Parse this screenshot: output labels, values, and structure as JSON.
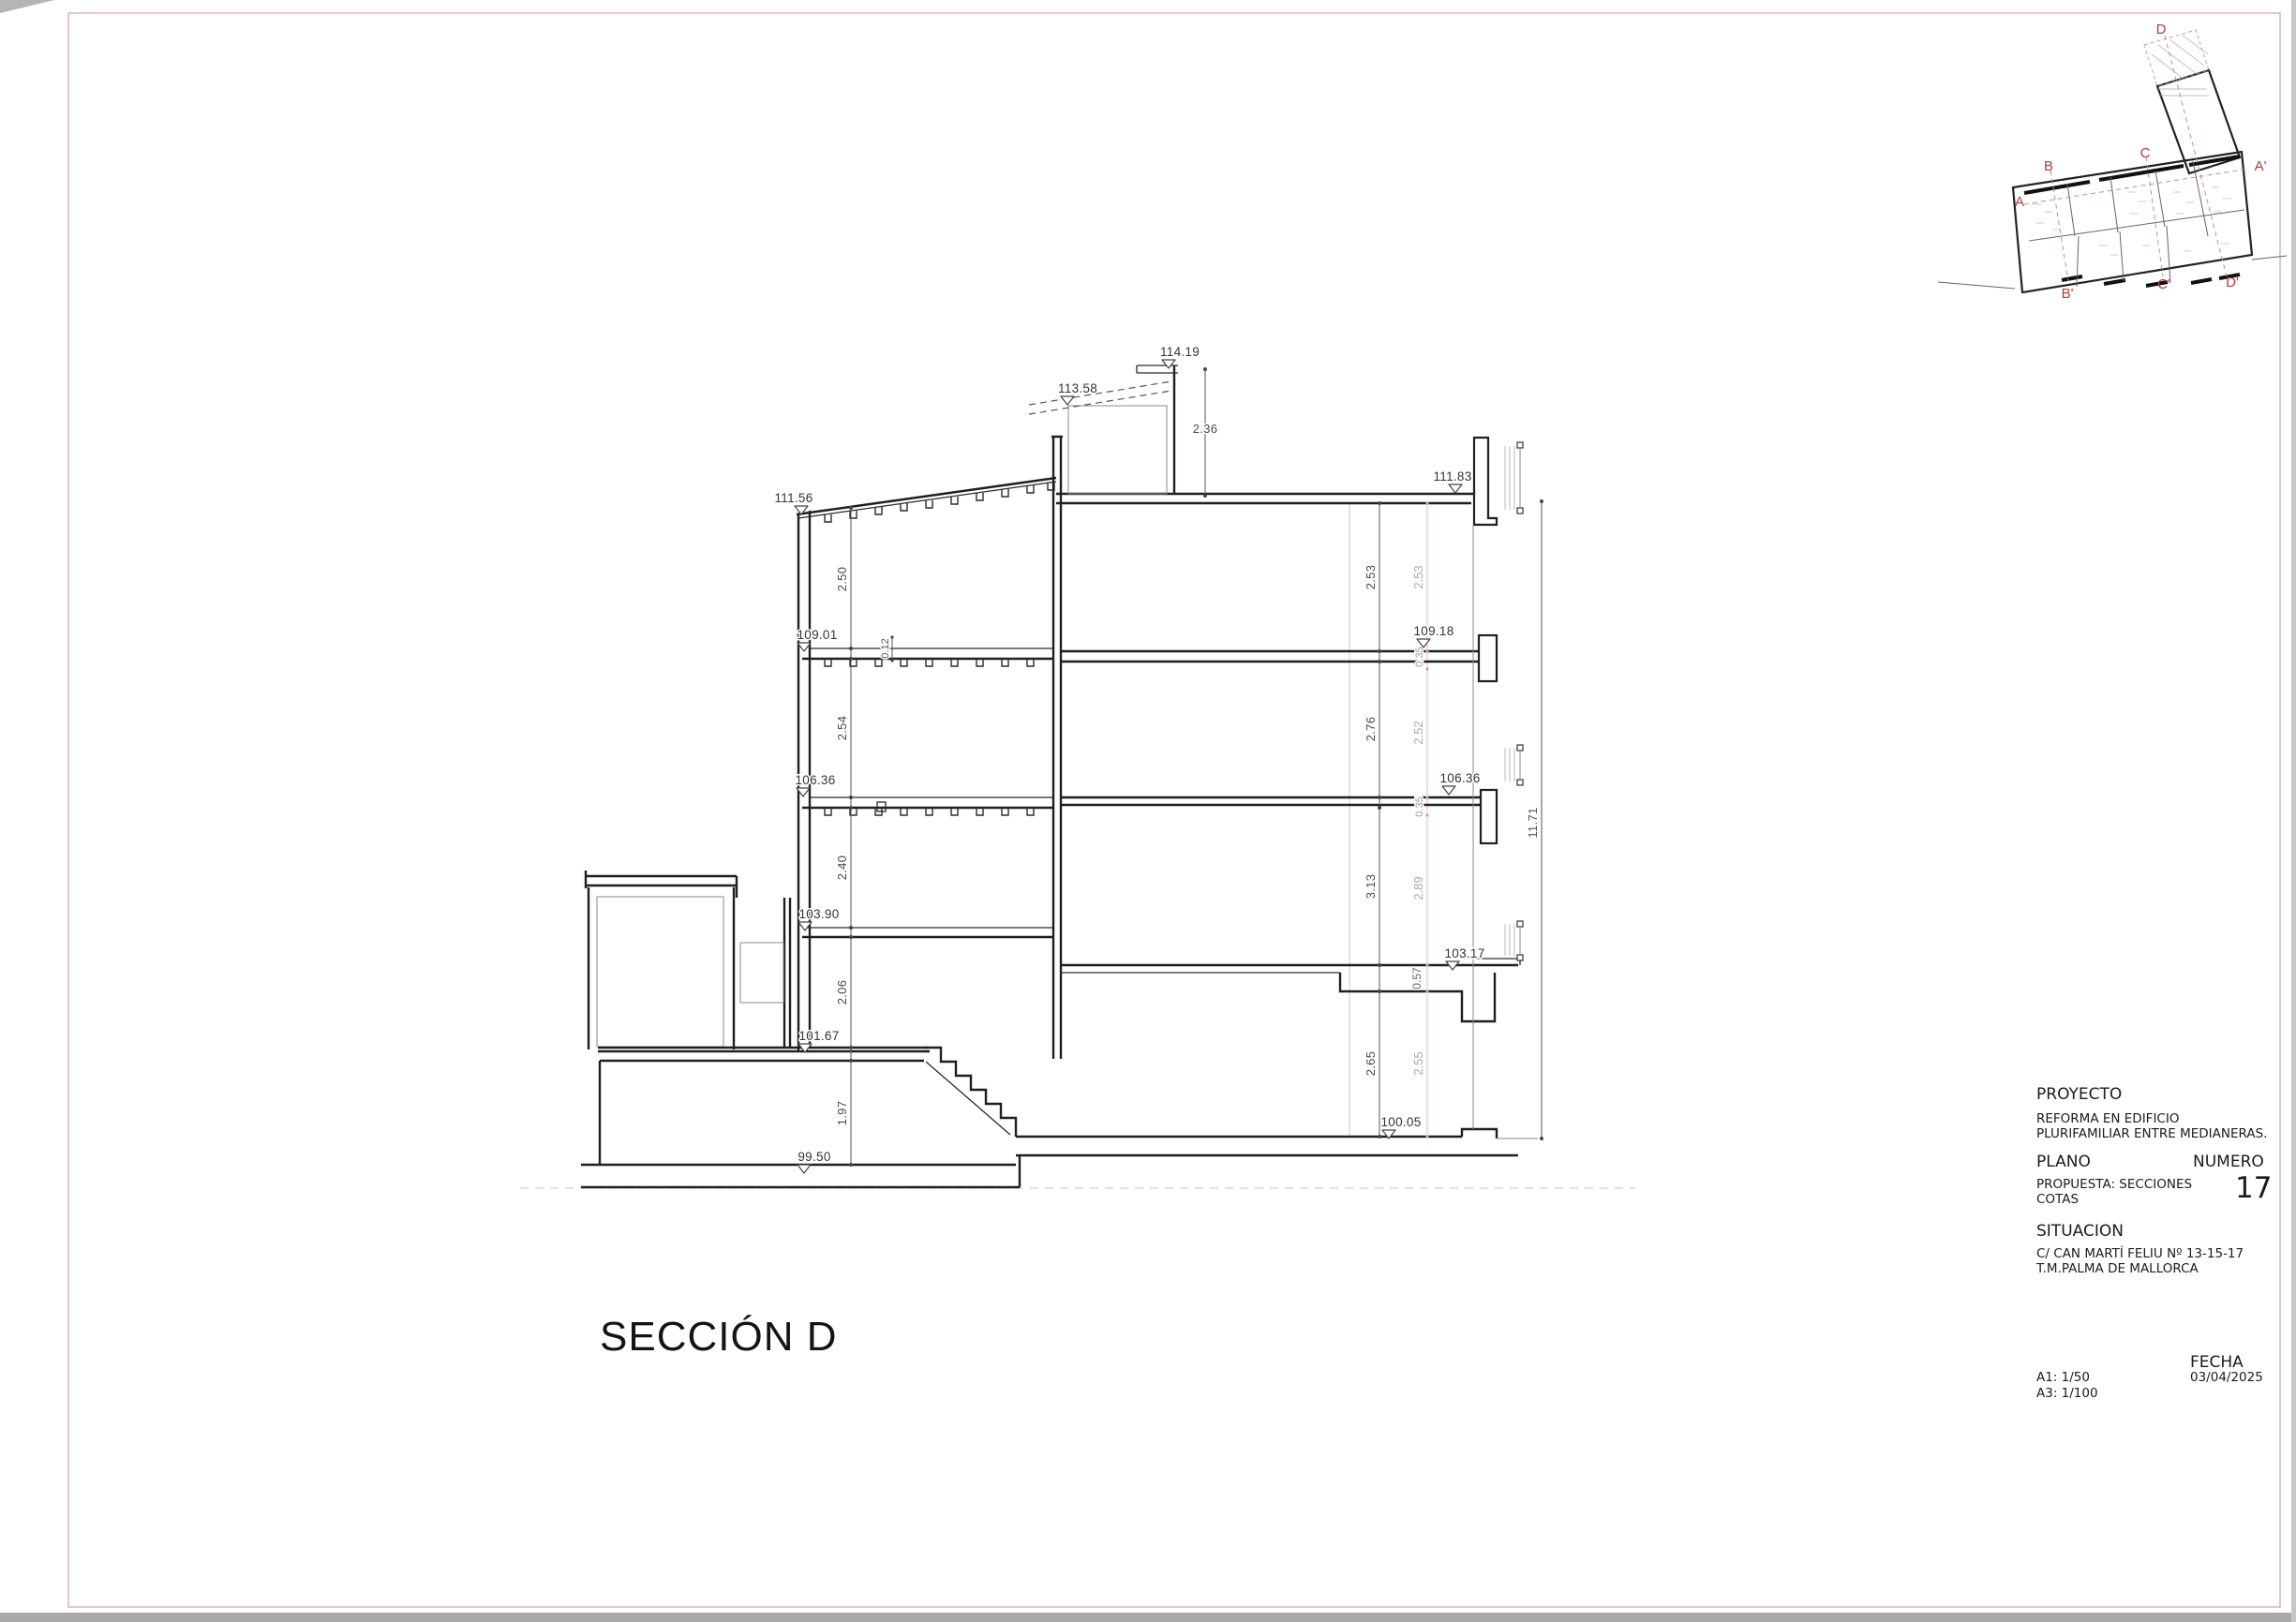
{
  "page": {
    "background": "#ffffff",
    "frame_color": "#d9a7a7",
    "outside_gray": "#a9a9a9"
  },
  "section": {
    "title": "SECCIÓN D"
  },
  "title_block": {
    "proyecto_label": "PROYECTO",
    "proyecto_line1": "REFORMA EN EDIFICIO",
    "proyecto_line2": "PLURIFAMILIAR ENTRE MEDIANERAS.",
    "plano_label": "PLANO",
    "plano_line1": "PROPUESTA: SECCIONES",
    "plano_line2": "COTAS",
    "numero_label": "NUMERO",
    "numero_value": "17",
    "situacion_label": "SITUACION",
    "situacion_line1": "C/ CAN MARTÍ FELIU Nº 13-15-17",
    "situacion_line2": "T.M.PALMA DE MALLORCA",
    "fecha_label": "FECHA",
    "fecha_value": "03/04/2025",
    "escala_a1": "A1: 1/50",
    "escala_a3": "A3: 1/100"
  },
  "key_plan": {
    "marker_color": "#b23b3b",
    "labels": {
      "a": "A",
      "b": "B",
      "c": "C",
      "d": "D",
      "a_prime": "A'",
      "b_prime": "B'",
      "c_prime": "C'",
      "d_prime": "D'"
    }
  },
  "drawing": {
    "levels": {
      "top": "114.19",
      "roof_back": "113.58",
      "roof_left": "111.56",
      "roof_right": "111.83",
      "floor3_left": "109.01",
      "floor3_right": "109.18",
      "floor2_left": "106.36",
      "floor2_right": "106.36",
      "floor1_left": "103.90",
      "floor1_right": "103.17",
      "ground_left_upper": "101.67",
      "ground_right": "100.05",
      "street": "99.50"
    },
    "dims": {
      "bulkhead_height": "2.36",
      "room3_left": "2.50",
      "room2_left": "2.54",
      "room1_left": "2.40",
      "ground_left": "2.06",
      "basement_left": "1.97",
      "joist_depth": "0.12",
      "room3_right": "2.53",
      "room3_right_b": "2.53",
      "slab3": "0.35",
      "room2_right": "2.76",
      "room2_right_b": "2.52",
      "slab2": "0.35",
      "room1_right": "3.13",
      "room1_right_b": "2.89",
      "slab1": "0.57",
      "ground_right": "2.65",
      "ground_right_b": "2.55",
      "total_height": "11.71"
    }
  }
}
